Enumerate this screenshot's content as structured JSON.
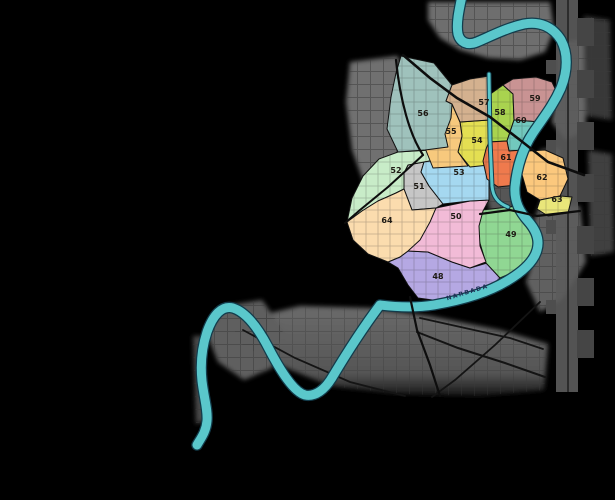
{
  "map": {
    "background": "#000000",
    "river": {
      "name": "NARBADA",
      "color": "#5ac7cb",
      "outline": "#123c4c",
      "width": 9,
      "path": "M462,-4 C459,10 456,24 458,34 C460,42 467,46 477,42 C489,37 506,28 524,24 C540,21 553,27 561,40 C568,53 568,70 561,88 C553,106 543,118 533,133 C523,148 517,166 515,187 C514,202 520,212 528,221 C536,230 540,240 537,250 C534,261 524,271 507,281 C489,292 463,300 434,305 C415,308 396,307 380,305 C365,325 348,351 333,376 C325,390 315,397 305,395 C294,392 281,372 268,347 C258,328 246,312 233,308 C222,305 213,315 207,332 C202,347 200,362 202,381 C204,398 208,410 207,421 C206,432 201,438 197,445",
      "label": {
        "x": 468,
        "y": 294,
        "rotate": -17
      }
    },
    "canal": {
      "color": "#5ac7cb",
      "outline": "#123c4c",
      "path": "M489,74 L490,140 L492,186 C493,197 498,203 508,207"
    },
    "wards": [
      {
        "number": "48",
        "color": "#b5a8e3",
        "label_x": 438,
        "label_y": 279,
        "points": "398,268 388,262 400,257 408,251 428,252 452,262 470,268 487,263 500,278 486,290 462,297 440,301 418,298 408,285"
      },
      {
        "number": "49",
        "color": "#90d793",
        "label_x": 511,
        "label_y": 237,
        "points": "482,210 518,206 527,220 535,233 537,246 531,258 518,270 500,278 486,263 479,240 479,221"
      },
      {
        "number": "50",
        "color": "#f2bbd7",
        "label_x": 456,
        "label_y": 219,
        "points": "436,208 470,201 489,200 483,211 479,226 480,246 486,262 470,268 452,262 428,252 408,251 418,236 428,221"
      },
      {
        "number": "51",
        "color": "#c6c6c6",
        "label_x": 419,
        "label_y": 189,
        "points": "408,165 424,162 421,172 429,186 443,204 436,208 412,210 404,189 404,173"
      },
      {
        "number": "52",
        "color": "#c8ecc8",
        "label_x": 396,
        "label_y": 173,
        "points": "398,152 448,149 448,158 424,162 408,165 404,173 404,189 396,193 378,201 362,211 347,222 352,198 363,176 379,159"
      },
      {
        "number": "53",
        "color": "#a5d8f0",
        "label_x": 459,
        "label_y": 175,
        "points": "424,162 448,158 489,153 489,200 470,201 443,204 429,186 421,172"
      },
      {
        "number": "54",
        "color": "#e4df52",
        "label_x": 477,
        "label_y": 143,
        "points": "460,122 489,120 489,165 470,167 458,152 462,136"
      },
      {
        "number": "55",
        "color": "#f7c97d",
        "label_x": 451,
        "label_y": 134,
        "points": "429,106 452,104 460,122 462,136 458,152 468,166 433,168 425,148 427,125"
      },
      {
        "number": "56",
        "color": "#9fc2bc",
        "label_x": 423,
        "label_y": 116,
        "points": "401,56 434,63 452,85 446,101 452,104 451,118 445,134 448,147 425,150 398,152 387,129 391,97 396,73"
      },
      {
        "number": "57",
        "color": "#d4b18f",
        "label_x": 484,
        "label_y": 105,
        "points": "452,85 470,79 489,76 489,120 460,122 452,104 446,101"
      },
      {
        "number": "58",
        "color": "#a9d34f",
        "label_x": 500,
        "label_y": 115,
        "points": "489,95 503,85 513,94 514,120 507,141 489,142"
      },
      {
        "number": "59",
        "color": "#c99393",
        "label_x": 535,
        "label_y": 101,
        "points": "503,85 513,79 536,77 552,82 558,95 552,112 540,122 527,121 514,120 513,94"
      },
      {
        "number": "60",
        "color": "#72c8bd",
        "label_x": 521,
        "label_y": 123,
        "points": "514,120 527,121 540,122 536,139 524,150 509,151 507,141"
      },
      {
        "number": "61",
        "color": "#ef7a4d",
        "label_x": 506,
        "label_y": 160,
        "points": "489,142 507,141 509,151 524,150 519,166 516,185 498,187 487,179 483,161 486,149"
      },
      {
        "number": "62",
        "color": "#fbc87d",
        "label_x": 542,
        "label_y": 180,
        "points": "528,151 545,150 563,158 568,179 560,196 540,200 527,192 521,171 523,158"
      },
      {
        "number": "63",
        "color": "#e9e67a",
        "label_x": 557,
        "label_y": 202,
        "points": "540,200 560,196 572,197 568,213 548,216 537,209"
      },
      {
        "number": "64",
        "color": "#fbdcae",
        "label_x": 387,
        "label_y": 223,
        "points": "347,222 362,211 378,201 396,193 404,189 412,210 436,208 430,222 420,240 408,251 400,257 388,262 368,254 353,240"
      }
    ],
    "gray_areas": [
      {
        "points": "428,2 550,2 554,30 545,52 520,60 488,58 460,50 440,38 428,20",
        "fill": "#6e6e6e"
      },
      {
        "points": "560,42 584,40 586,130 566,140 552,122 560,80",
        "fill": "#686868"
      },
      {
        "points": "350,62 398,56 404,92 414,140 421,178 400,198 368,194 352,150 346,102",
        "fill": "#6f6f6f"
      },
      {
        "points": "488,168 514,166 513,208 504,220 490,212 485,188",
        "fill": "#575757"
      },
      {
        "points": "540,150 560,148 556,206 580,206 586,262 562,300 540,312 526,282 538,244 532,225 540,205 548,180",
        "fill": "#606060"
      },
      {
        "points": "232,322 300,306 370,308 430,316 500,330 548,344 544,390 480,396 400,394 330,386 272,362 238,342",
        "fill": "url(#fadeGray)",
        "fade": true
      },
      {
        "points": "225,306 262,300 283,330 272,368 244,380 218,362 206,332",
        "fill": "#5f5f5f"
      },
      {
        "points": "193,336 203,336 206,420 196,424",
        "fill": "#4a4a4a"
      },
      {
        "points": "588,150 612,154 614,252 590,256",
        "fill": "#3f3f3f"
      },
      {
        "points": "584,16 610,20 612,120 586,116",
        "fill": "#383838"
      }
    ],
    "railway": {
      "band": {
        "x": 556,
        "y": 0,
        "w": 22,
        "h": 392,
        "fill": "#5c5c5c"
      },
      "inner_line": {
        "x": 567,
        "fill": "#2c2c2c"
      },
      "right_blocks_y": [
        18,
        70,
        122,
        174,
        226,
        278,
        330
      ],
      "right_block": {
        "x": 577,
        "w": 17,
        "h": 28,
        "fill": "#454545"
      },
      "left_blocks_y": [
        60,
        140,
        220,
        300
      ],
      "left_block": {
        "x": 546,
        "w": 10,
        "h": 14,
        "fill": "#4e4e4e"
      }
    },
    "fan_roads": [
      {
        "d": "M417,332 L458,348 L505,363 L545,377",
        "w": 2
      },
      {
        "d": "M420,318 L465,328 L510,338 L543,349",
        "w": 1.8
      },
      {
        "d": "M540,302 L495,345 L455,380 L432,397",
        "w": 1.8
      },
      {
        "d": "M243,330 L295,358 L350,382 L405,396",
        "w": 1.8
      }
    ],
    "roads": [
      {
        "d": "M403,55 L430,78 L457,98 L490,117 L520,140 L548,162 L584,175",
        "w": 2.6
      },
      {
        "d": "M396,60 Q399,90 406,115 Q413,140 423,155",
        "w": 2.2
      },
      {
        "d": "M423,155 L388,187 L360,210 L345,223",
        "w": 2
      },
      {
        "d": "M410,297 L417,330 L430,365 L440,396",
        "w": 2.2
      },
      {
        "d": "M480,214 L510,210 L537,216 L580,211",
        "w": 2.2
      }
    ]
  }
}
